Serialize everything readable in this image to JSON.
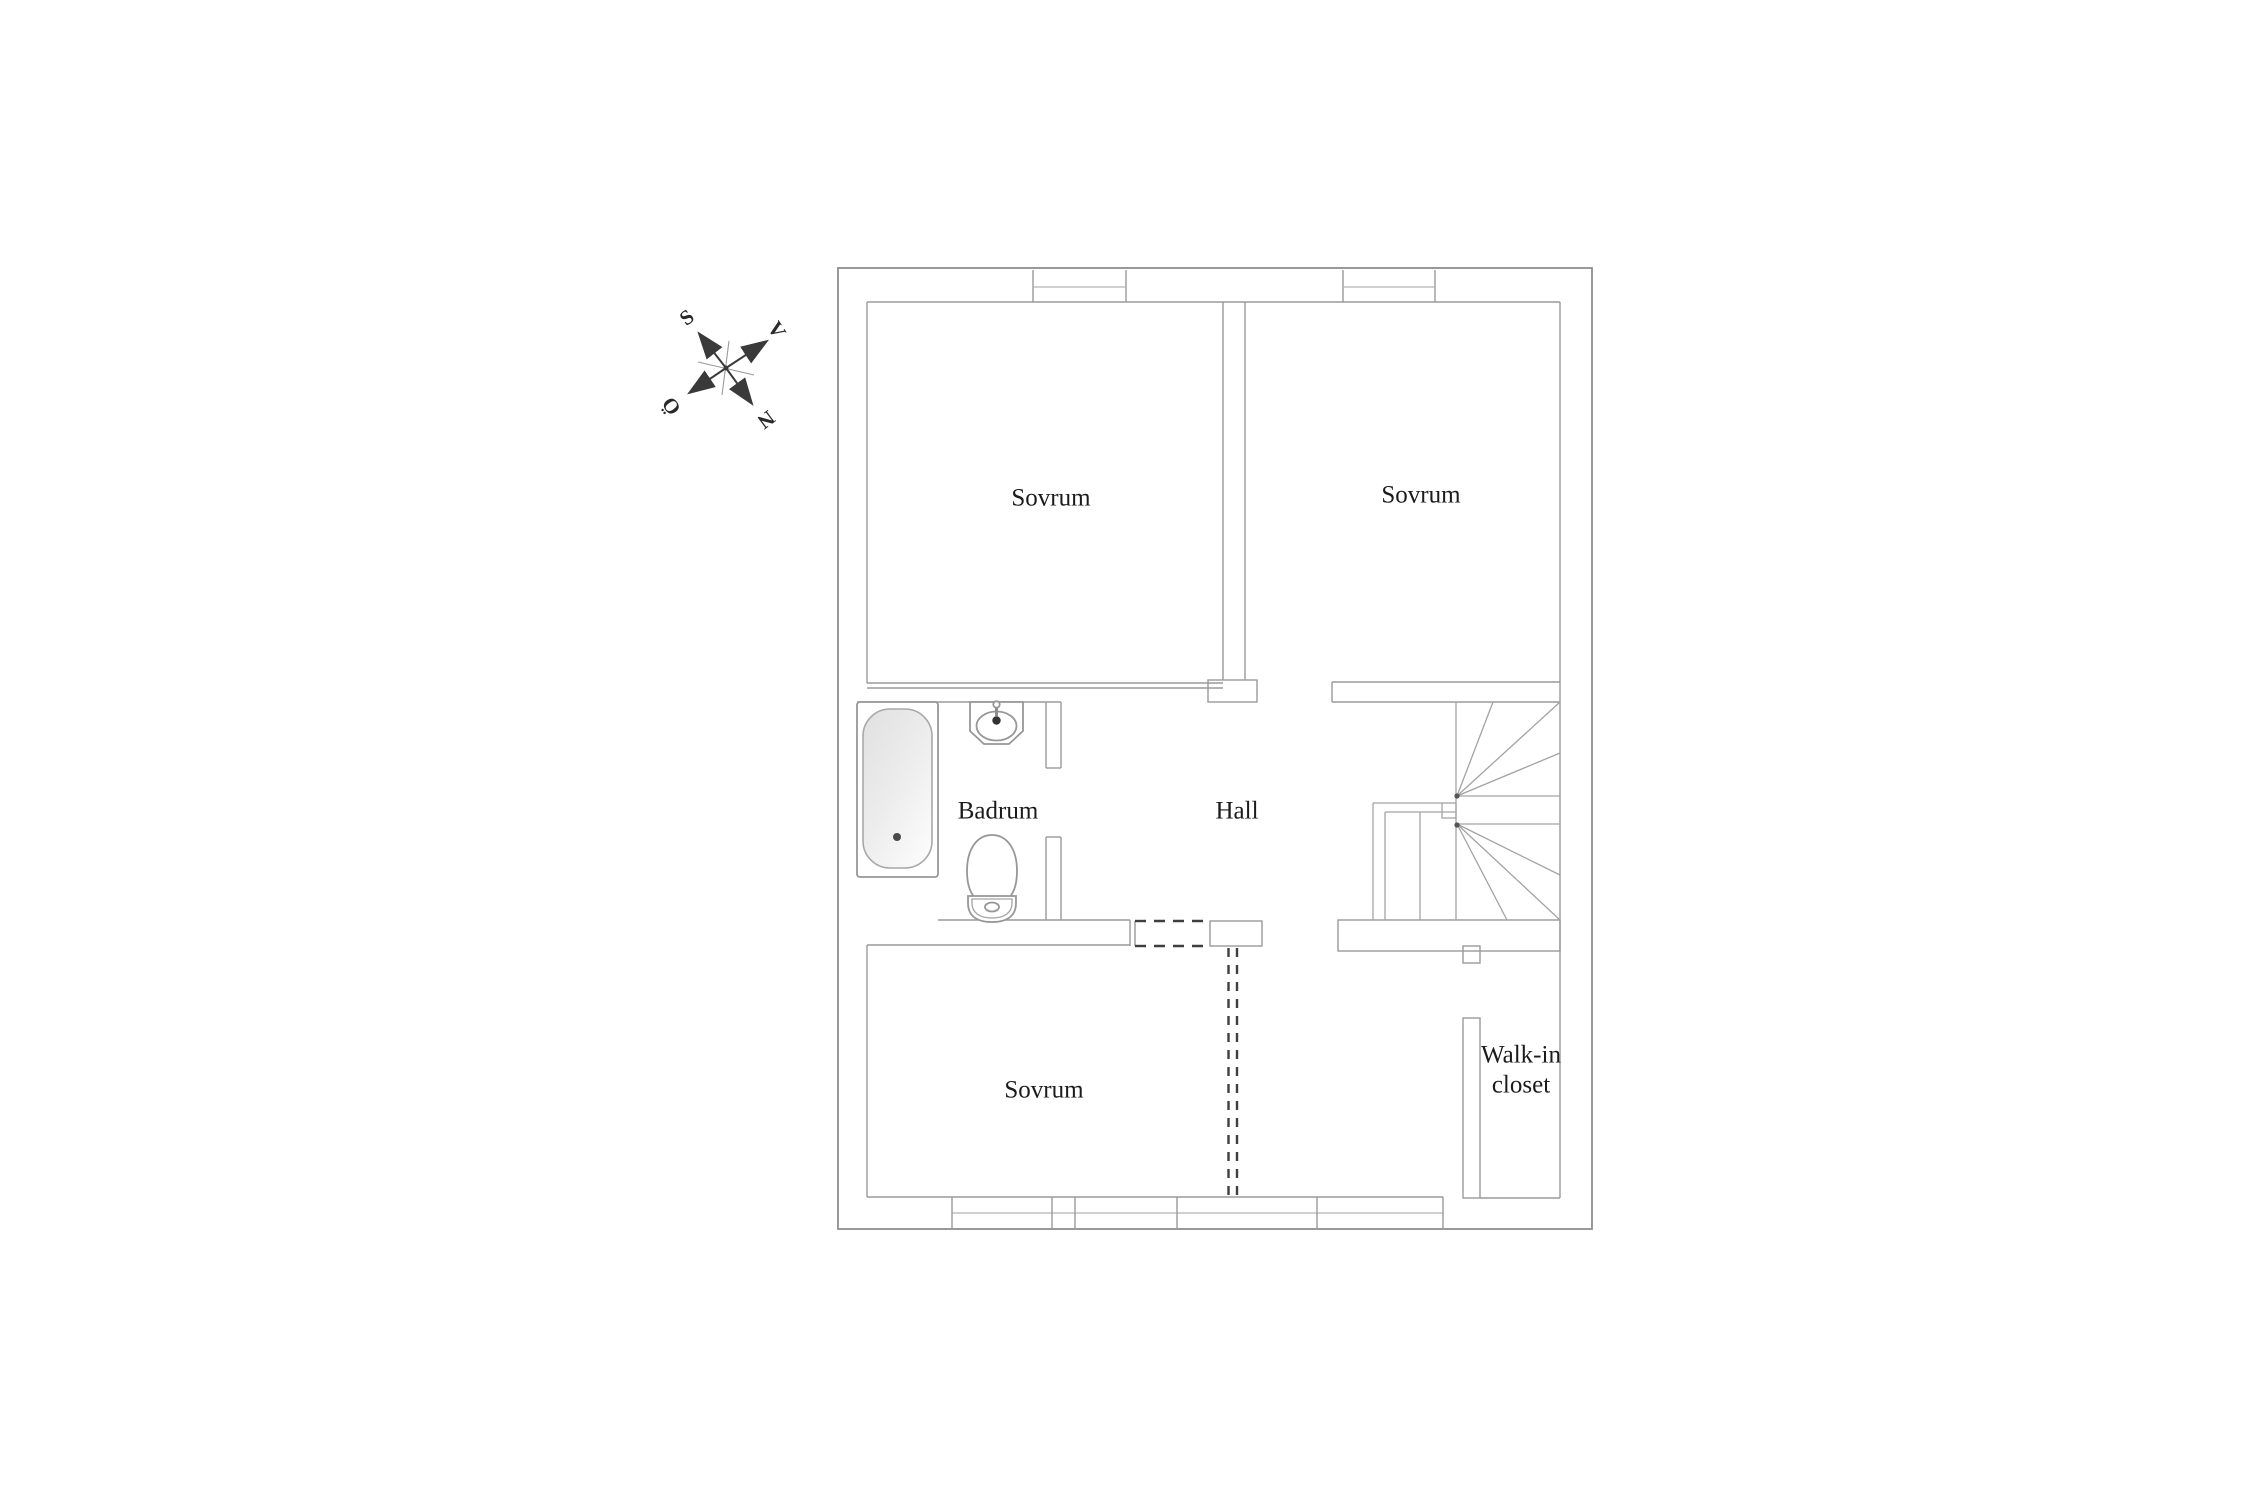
{
  "floor_plan": {
    "rooms": {
      "bedroom_top_left": {
        "label": "Sovrum"
      },
      "bedroom_top_right": {
        "label": "Sovrum"
      },
      "bedroom_bottom": {
        "label": "Sovrum"
      },
      "bathroom": {
        "label": "Badrum"
      },
      "hall": {
        "label": "Hall"
      },
      "walk_in_closet": {
        "label_line1": "Walk-in",
        "label_line2": "closet"
      }
    },
    "fixtures": [
      "bathtub-icon",
      "sink-icon",
      "toilet-icon",
      "staircase-icon"
    ],
    "compass": {
      "south": "S",
      "west": "V",
      "east": "Ö",
      "north": "N"
    },
    "colors": {
      "wall_line": "#8e8e8e",
      "fixture_line": "#979797",
      "dashed_line": "#3f3f3f",
      "text": "#1b1b1b",
      "compass": "#3a3a3a",
      "tub_fill_dark": "#e3e3e3",
      "tub_fill_light": "#fafafa",
      "background": "#ffffff"
    }
  }
}
